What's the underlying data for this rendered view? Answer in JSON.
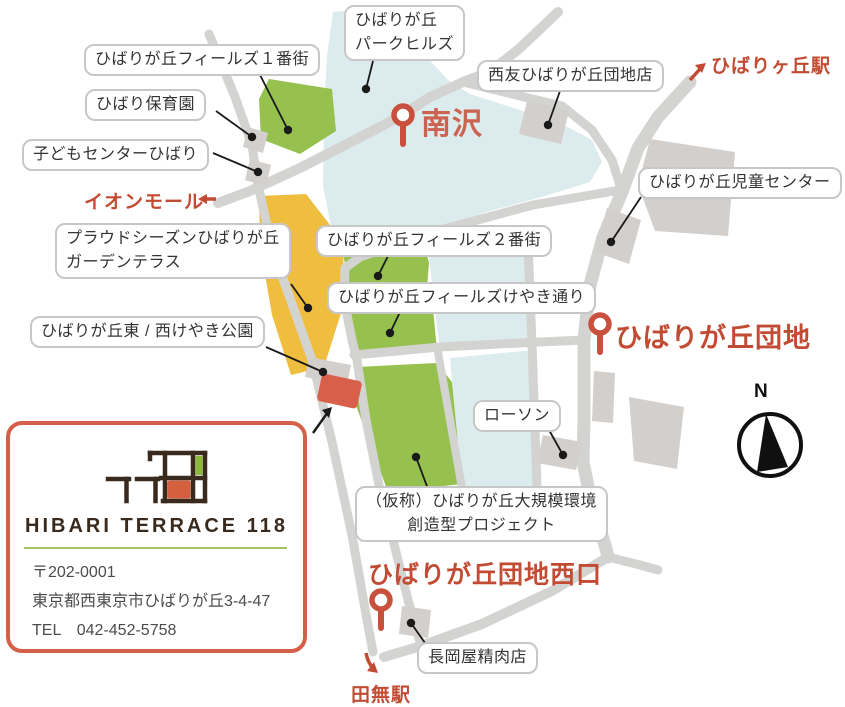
{
  "bubbles": {
    "fields1": "ひばりが丘フィールズ１番街",
    "hoikuen": "ひばり保育園",
    "kodomo": "子どもセンターひばり",
    "parkhills": "ひばりが丘\nパークヒルズ",
    "seiyu": "西友ひばりが丘団地店",
    "jido": "ひばりが丘児童センター",
    "proud": "プラウドシーズンひばりが丘\nガーデンテラス",
    "fields2": "ひばりが丘フィールズ２番街",
    "keyaki_street": "ひばりが丘フィールズけやき通り",
    "keyaki_park": "ひばりが丘東 / 西けやき公園",
    "lawson": "ローソン",
    "project": "（仮称）ひばりが丘大規模環境\n創造型プロジェクト",
    "nagaoka": "長岡屋精肉店"
  },
  "red_labels": {
    "hibarigaoka_station": "ひばりヶ丘駅",
    "aeon_mall": "イオンモール",
    "minamisawa": "南沢",
    "danchi": "ひばりが丘団地",
    "danchi_west": "ひばりが丘団地西口",
    "tanashi_station": "田無駅"
  },
  "compass": {
    "north": "N"
  },
  "icons": {
    "map_pin": "location-pin",
    "station_arrow_ne": "↗",
    "aeon_arrow_left": "←",
    "tanashi_arrow_down": "↘",
    "compass_rose": "compass-north-needle"
  },
  "card": {
    "brand": "HIBARI TERRACE 118",
    "logo_text": "118",
    "postal": "〒202-0001",
    "address": "東京都西東京市ひばりが丘3-4-47",
    "tel": "TEL　042-452-5758"
  },
  "colors": {
    "area_water": "#dcebed",
    "park_green": "#96c14f",
    "highlight_orange": "#efbe3f",
    "target_red": "#d8604a",
    "road": "#d3d3d1",
    "building": "#d2cfcc",
    "label_red": "#c24b33",
    "label_red_soft": "#cb6350",
    "pin_red": "#c9503c",
    "leader_black": "#1a1a1a",
    "card_border": "#d5604a",
    "logo_brown": "#3a2a1d",
    "logo_green": "#8cb83e",
    "logo_orange": "#d4603f",
    "separator_green": "#a6c45c"
  }
}
